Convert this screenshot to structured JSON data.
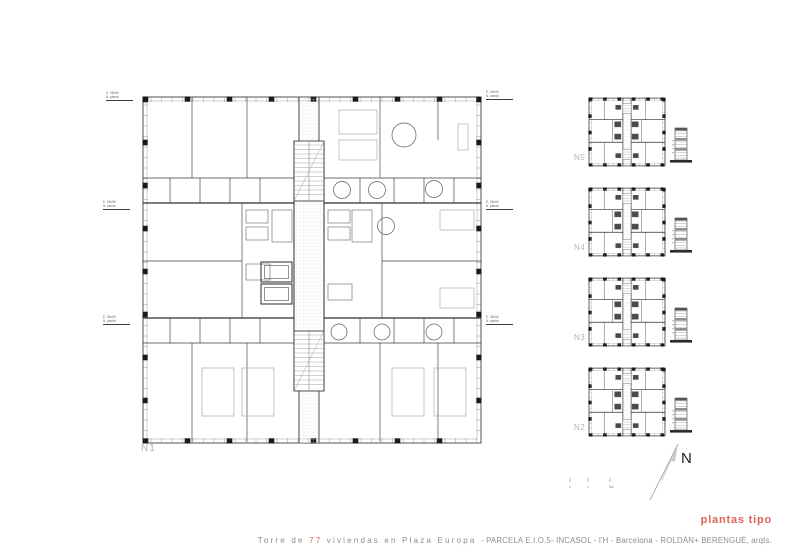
{
  "colors": {
    "accent": "#e0645c",
    "ink": "#3d3d3d",
    "dark": "#1a1a1a",
    "faint_label": "#b4b4b4",
    "hatch": "#e2e2e2"
  },
  "main_plan": {
    "label": "N1",
    "level_notes": [
      {
        "l1": "E. 28x06",
        "l2": "N. planta"
      },
      {
        "l1": "E. 28x06",
        "l2": "N. planta"
      },
      {
        "l1": "E. 28x06",
        "l2": "N. planta"
      },
      {
        "l1": "E. 28x06",
        "l2": "N. planta"
      },
      {
        "l1": "E. 28x06",
        "l2": "N. planta"
      },
      {
        "l1": "E. 28x06",
        "l2": "N. planta"
      }
    ]
  },
  "mini_plans": [
    {
      "label": "N5"
    },
    {
      "label": "N4"
    },
    {
      "label": "N3"
    },
    {
      "label": "N2"
    }
  ],
  "north": {
    "label": "N"
  },
  "scale_bar": {
    "ticks": [
      "0",
      "1",
      "5m"
    ]
  },
  "footer": {
    "plantas_label": "plantas tipo",
    "title_segments": [
      {
        "text": "Torre de ",
        "spaced": true,
        "red": false
      },
      {
        "text": "77",
        "spaced": true,
        "red": true
      },
      {
        "text": " viviendas en Plaza Europa ",
        "spaced": true,
        "red": false
      },
      {
        "text": "- PARCELA E.I.O.5- INCASOL - l'H - Barcelona - ROLDÁN+ BERENGUÉ, arqts.",
        "spaced": false,
        "red": false
      }
    ]
  }
}
